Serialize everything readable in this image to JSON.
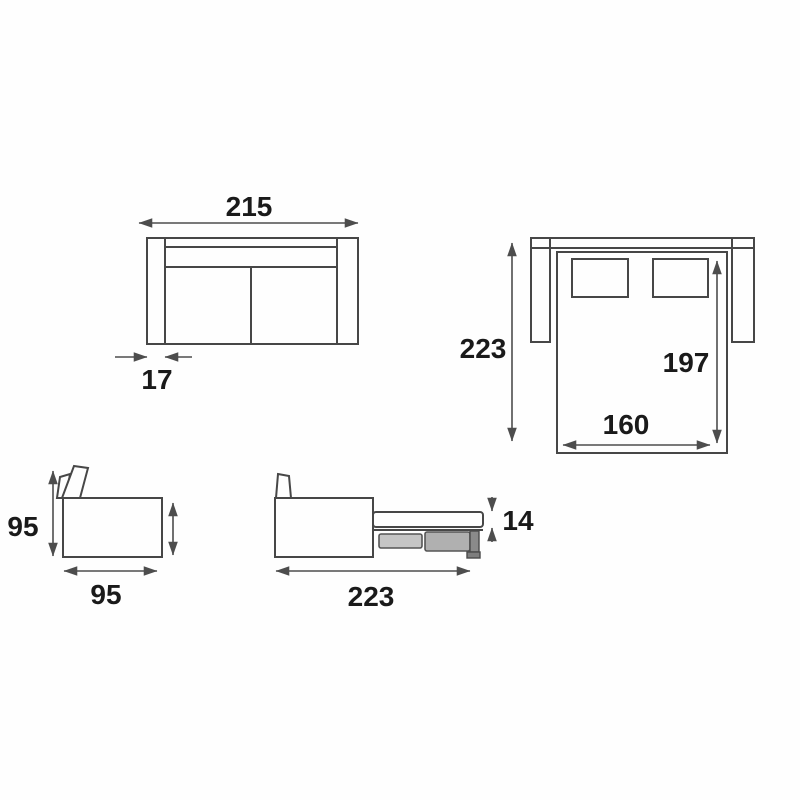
{
  "colors": {
    "background": "#fefefe",
    "furniture_line": "#474747",
    "dimension_line": "#4d4d4d",
    "label_text": "#1a1a1a",
    "slat_light": "#c5c5c5",
    "slat_dark": "#b0b0b0",
    "leg_gray": "#8a8a8a"
  },
  "views": {
    "sofa_front": {
      "overall_width": "215",
      "armrest_width": "17"
    },
    "bed_top": {
      "overall_depth": "223",
      "bed_length": "197",
      "bed_width": "160"
    },
    "sofa_side": {
      "height": "95",
      "depth": "95"
    },
    "bed_side": {
      "mattress_thickness": "14",
      "open_depth": "223"
    }
  }
}
